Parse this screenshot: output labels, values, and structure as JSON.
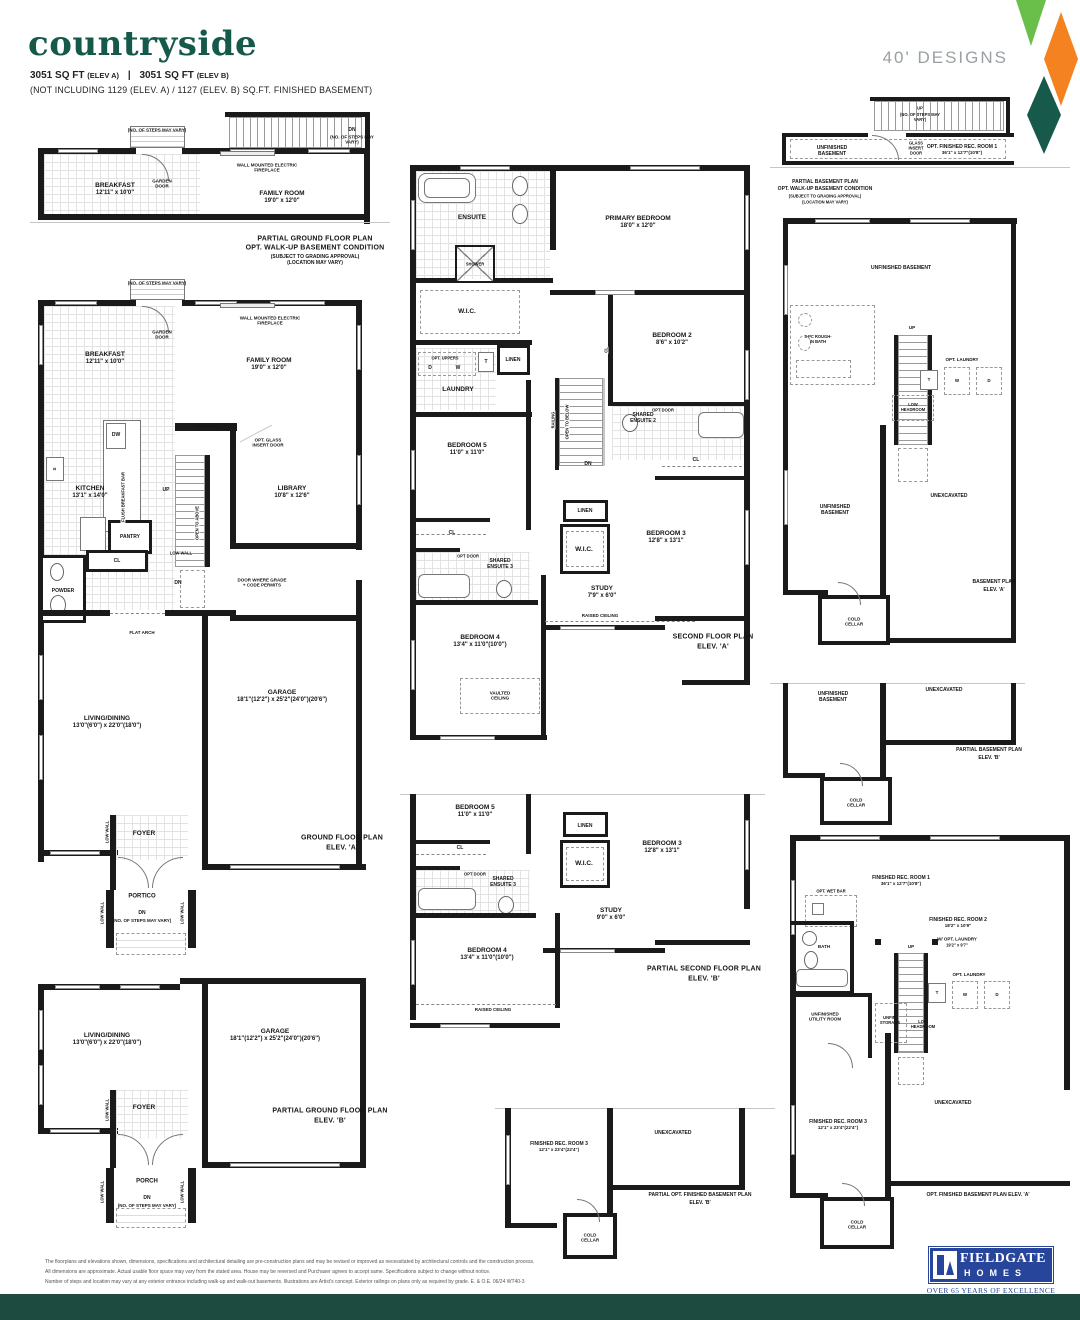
{
  "header": {
    "title": "countryside",
    "sq1": "3051 SQ FT",
    "e1": "(ELEV A)",
    "sep": "|",
    "sq2": "3051 SQ FT",
    "e2": "(ELEV B)",
    "note": "(NOT INCLUDING 1129 (ELEV. A) / 1127 (ELEV. B) SQ.FT. FINISHED BASEMENT)",
    "designs": "40' DESIGNS"
  },
  "colors": {
    "title_green": "#15594a",
    "diamond_green": "#6abf4b",
    "diamond_orange": "#f58220",
    "diamond_teal": "#175a4c",
    "footer_bar": "#1d4b40",
    "logo_blue": "#27459b"
  },
  "p1": {
    "steps": "(NO. OF STEPS MAY VARY)",
    "garden": "GARDEN DOOR",
    "dn": "DN",
    "dn2": "(NO. OF STEPS MAY VARY)",
    "fire": "WALL MOUNTED ELECTRIC FIREPLACE",
    "breakfast": "BREAKFAST",
    "breakfast_d": "12'11\" x 10'0\"",
    "family": "FAMILY ROOM",
    "family_d": "19'0\" x 12'0\"",
    "cap1": "PARTIAL GROUND FLOOR PLAN",
    "cap2": "OPT. WALK-UP BASEMENT CONDITION",
    "cap3": "(SUBJECT TO GRADING APPROVAL)",
    "cap4": "(LOCATION MAY VARY)"
  },
  "p2": {
    "steps": "(NO. OF STEPS MAY VARY)",
    "garden": "GARDEN DOOR",
    "fire": "WALL MOUNTED ELECTRIC FIREPLACE",
    "breakfast": "BREAKFAST",
    "breakfast_d": "12'11\" x 10'0\"",
    "family": "FAMILY ROOM",
    "family_d": "19'0\" x 12'0\"",
    "dw": "DW",
    "s": "S",
    "f": "F",
    "flush": "FLUSH BREAKFAST BAR",
    "lowwall": "LOW WALL",
    "optglass": "OPT. GLASS INSERT DOOR",
    "kitchen": "KITCHEN",
    "kitchen_d": "13'1\" x 14'0\"",
    "up": "UP",
    "open": "OPEN TO ABOVE",
    "dn": "DN",
    "library": "LIBRARY",
    "library_d": "10'8\" x 12'6\"",
    "pantry": "PANTRY",
    "cl": "CL",
    "powder": "POWDER",
    "grade": "DOOR WHERE GRADE + CODE PERMITS",
    "arch": "FLAT ARCH",
    "living": "LIVING/DINING",
    "living_d": "13'0\"(6'0\") x 22'0\"(18'0\")",
    "garage": "GARAGE",
    "garage_d": "18'1\"(12'2\") x 25'2\"(24'0\")(20'6\")",
    "foyer": "FOYER",
    "portico": "PORTICO",
    "dn2": "DN",
    "dn2n": "(NO. OF STEPS MAY VARY)",
    "cap1": "GROUND FLOOR PLAN",
    "cap2": "ELEV. 'A'"
  },
  "p3": {
    "living": "LIVING/DINING",
    "living_d": "13'0\"(6'0\") x 22'0\"(18'0\")",
    "garage": "GARAGE",
    "garage_d": "18'1\"(12'2\") x 25'2\"(24'0\")(20'6\")",
    "foyer": "FOYER",
    "porch": "PORCH",
    "lowwall": "LOW WALL",
    "dn": "DN",
    "dnn": "(NO. OF STEPS MAY VARY)",
    "cap1": "PARTIAL GROUND FLOOR PLAN",
    "cap2": "ELEV. 'B'"
  },
  "p4": {
    "ensuite": "ENSUITE",
    "shower": "SHOWER",
    "primary": "PRIMARY BEDROOM",
    "primary_d": "18'0\" x 12'0\"",
    "wic": "W.I.C.",
    "uppers": "OPT. UPPERS",
    "d": "D",
    "w": "W",
    "t": "T",
    "linen": "LINEN",
    "laundry": "LAUNDRY",
    "bed2": "BEDROOM 2",
    "bed2_d": "8'6\" x 10'2\"",
    "cl": "CL",
    "railing": "RAILING",
    "open": "OPEN TO BELOW",
    "dn": "DN",
    "sh2a": "SHARED",
    "sh2b": "ENSUITE 2",
    "optdoor": "OPT DOOR",
    "bed5": "BEDROOM 5",
    "bed5_d": "11'0\" x 11'0\"",
    "sh3a": "SHARED",
    "sh3b": "ENSUITE 3",
    "bed3": "BEDROOM 3",
    "bed3_d": "12'8\" x 13'1\"",
    "study": "STUDY",
    "study_d": "7'9\" x 6'0\"",
    "raised": "RAISED CEILING",
    "bed4": "BEDROOM 4",
    "bed4_d": "13'4\" x 11'0\"(10'0\")",
    "vaulted": "VAULTED CEILING",
    "cap1": "SECOND FLOOR PLAN",
    "cap2": "ELEV. 'A'"
  },
  "p5": {
    "bed5": "BEDROOM 5",
    "bed5_d": "11'0\" x 11'0\"",
    "cl": "CL",
    "optdoor": "OPT DOOR",
    "sh3a": "SHARED",
    "sh3b": "ENSUITE 3",
    "linen": "LINEN",
    "wic": "W.I.C.",
    "bed3": "BEDROOM 3",
    "bed3_d": "12'8\" x 13'1\"",
    "study": "STUDY",
    "study_d": "9'0\" x 6'0\"",
    "bed4": "BEDROOM 4",
    "bed4_d": "13'4\" x 11'0\"(10'0\")",
    "raised": "RAISED CEILING",
    "cap1": "PARTIAL SECOND FLOOR PLAN",
    "cap2": "ELEV. 'B'"
  },
  "p6": {
    "up": "UP",
    "upn": "(NO. OF STEPS MAY VARY)",
    "unfin": "UNFINISHED BASEMENT",
    "glass": "GLASS INSERT DOOR",
    "rec1": "OPT. FINISHED REC. ROOM 1",
    "rec1_d": "36'1\" x 12'7\"(10'8\")",
    "cap1": "PARTIAL BASEMENT PLAN",
    "cap2": "OPT. WALK-UP BASEMENT CONDITION",
    "cap3": "(SUBJECT TO GRADING APPROVAL)",
    "cap4": "(LOCATION MAY VARY)"
  },
  "p7": {
    "unfin": "UNFINISHED BASEMENT",
    "bath": "4-PC ROUGH-IN BATH",
    "up": "UP",
    "laundry": "OPT. LAUNDRY",
    "t": "T",
    "w": "W",
    "d": "D",
    "lowhead": "LOW HEADROOM",
    "unex": "UNEXCAVATED",
    "cold": "COLD CELLAR",
    "cap1": "BASEMENT PLAN",
    "cap2": "ELEV. 'A'"
  },
  "p8": {
    "unfin": "UNFINISHED BASEMENT",
    "unex": "UNEXCAVATED",
    "cold": "COLD CELLAR",
    "cap1": "PARTIAL BASEMENT PLAN",
    "cap2": "ELEV. 'B'"
  },
  "p9": {
    "rec1": "FINISHED REC. ROOM 1",
    "rec1_d": "36'1\" x 12'7\"(10'8\")",
    "wetbar": "OPT. WET BAR",
    "bath": "BATH",
    "rec2": "FINISHED REC. ROOM 2",
    "rec2_d": "18'2\" x 10'9\"",
    "laun2": "W/ OPT. LAUNDRY",
    "laun2_d": "19'2\" x 9'7\"",
    "up": "UP",
    "laundry": "OPT. LAUNDRY",
    "t": "T",
    "w": "W",
    "d": "D",
    "storage": "UNFIN. STORAGE",
    "lowhead": "LOW HEADROOM",
    "utility": "UNFINISHED UTILITY ROOM",
    "rec3": "FINISHED REC. ROOM 3",
    "rec3_d": "12'1\" x 23'4\"(22'4\")",
    "unex": "UNEXCAVATED",
    "cold": "COLD CELLAR",
    "cap": "OPT. FINISHED BASEMENT PLAN ELEV. 'A'"
  },
  "p10": {
    "rec3": "FINISHED REC. ROOM 3",
    "rec3_d": "12'1\" x 23'4\"(22'4\")",
    "unex": "UNEXCAVATED",
    "cold": "COLD CELLAR",
    "cap1": "PARTIAL OPT. FINISHED BASEMENT PLAN",
    "cap2": "ELEV. 'B'"
  },
  "footer": {
    "line1": "The floorplans and elevations shown, dimensions, specifications and architectural detailing are pre-construction plans and may be revised or improved as necessitated by architectural controls and the construction process.",
    "line2": "All dimensions are approximate. Actual usable floor space may vary from the stated area. House may be reversed and Purchaser agrees to accept same. Specifications subject to change without notice.",
    "line3": "Number of steps and location may vary at any exterior entrance including walk-up and walk-out basements. Illustrations are Artist's concept. Exterior railings on plans only as required by grade. E. & O.E. 06/24 WT40-3",
    "brand": "FIELDGATE",
    "homes": "HOMES",
    "tag": "OVER 65 YEARS OF EXCELLENCE"
  }
}
